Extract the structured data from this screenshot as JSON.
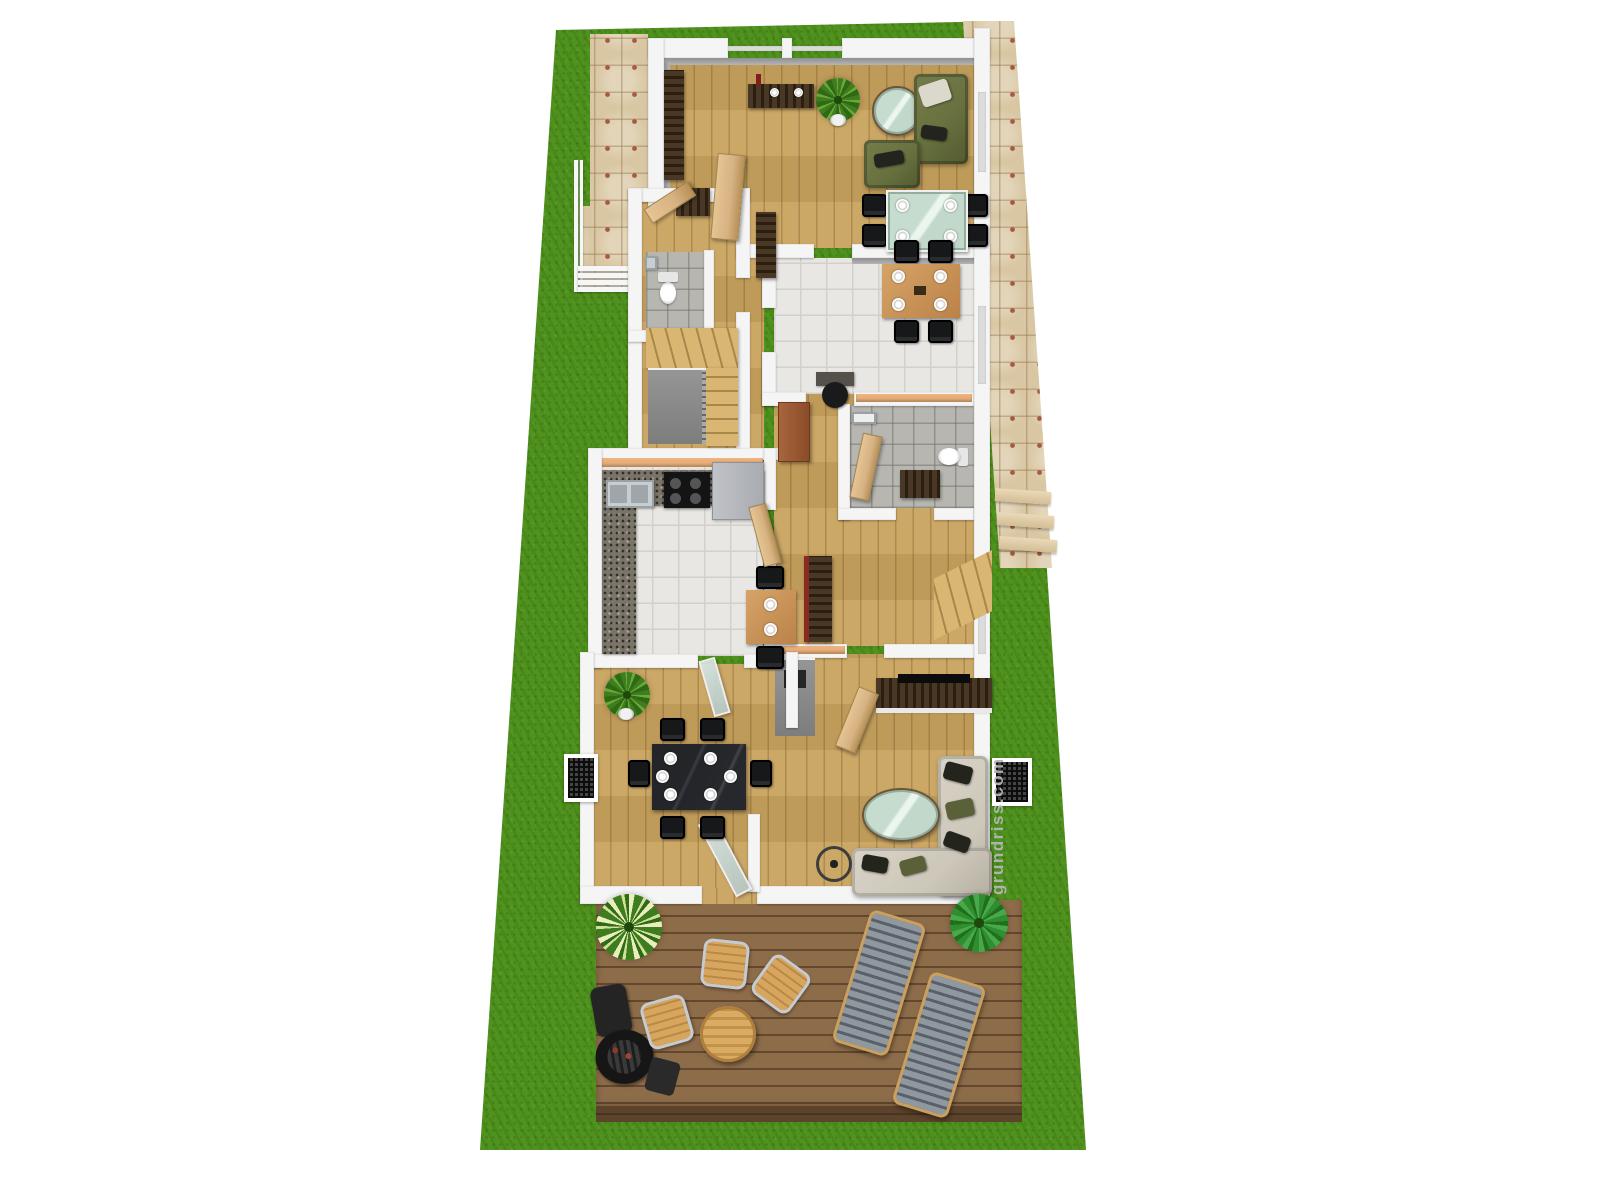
{
  "watermark": {
    "text": "grundriss.com"
  },
  "scene": {
    "type": "3d-floor-plan-render",
    "areas": [
      "garden-lawn",
      "stone-path",
      "entry-walkway",
      "entrance-porch",
      "upper-living-room",
      "entrance-hall",
      "wc",
      "upper-staircase",
      "middle-dining-room",
      "hallway",
      "bathroom",
      "kitchen",
      "lower-staircase",
      "lower-dining-room",
      "lower-living-room",
      "terrace-deck"
    ],
    "furniture": [
      "wall-shelf",
      "tv-sideboard",
      "potted-plant",
      "round-glass-coffee-table",
      "olive-sofa",
      "olive-armchair",
      "glass-dining-table",
      "black-dining-chairs",
      "coat-rack",
      "toilet",
      "hand-basin",
      "wooden-stairs",
      "wood-dining-table",
      "desk-with-office-chair",
      "wall-coat-hooks",
      "granite-kitchen-counter",
      "kitchen-sink",
      "cooktop-oven",
      "kitchen-cabinets",
      "kitchen-table",
      "tall-red-cabinet",
      "tv-lowboard-with-tv",
      "corner-sofa",
      "oval-glass-coffee-table",
      "floor-lamp",
      "marble-dining-table",
      "wall-vent-grille",
      "deck-bistro-chairs",
      "deck-round-table",
      "sun-loungers",
      "barbecue-grill",
      "deck-plants"
    ]
  },
  "colors": {
    "grass": "#4f921e",
    "path": "#d9c7a3",
    "grout": "#a65a40",
    "wall": "#f5f5f5",
    "wallFace": "#8f8f8f",
    "cap": "#e0a771",
    "wood": "#c9a35f",
    "tile": "#e9e7e3",
    "tileLine": "#d3d0ca",
    "bathTile": "#b7b6b1",
    "granite": "#7b7468",
    "door": "#d7b283",
    "darkWood": "#4a3826",
    "olive": "#68713f",
    "sofaBeige": "#cdc7ba",
    "glass": "#c2d8ca",
    "marble": "#26282b",
    "deck": "#8d6c49",
    "deckSeam": "#63482e",
    "lounger": "#8f979f",
    "tan": "#d7a55c",
    "metal": "#c6cbd1",
    "watermark": "#b5b5b5"
  }
}
